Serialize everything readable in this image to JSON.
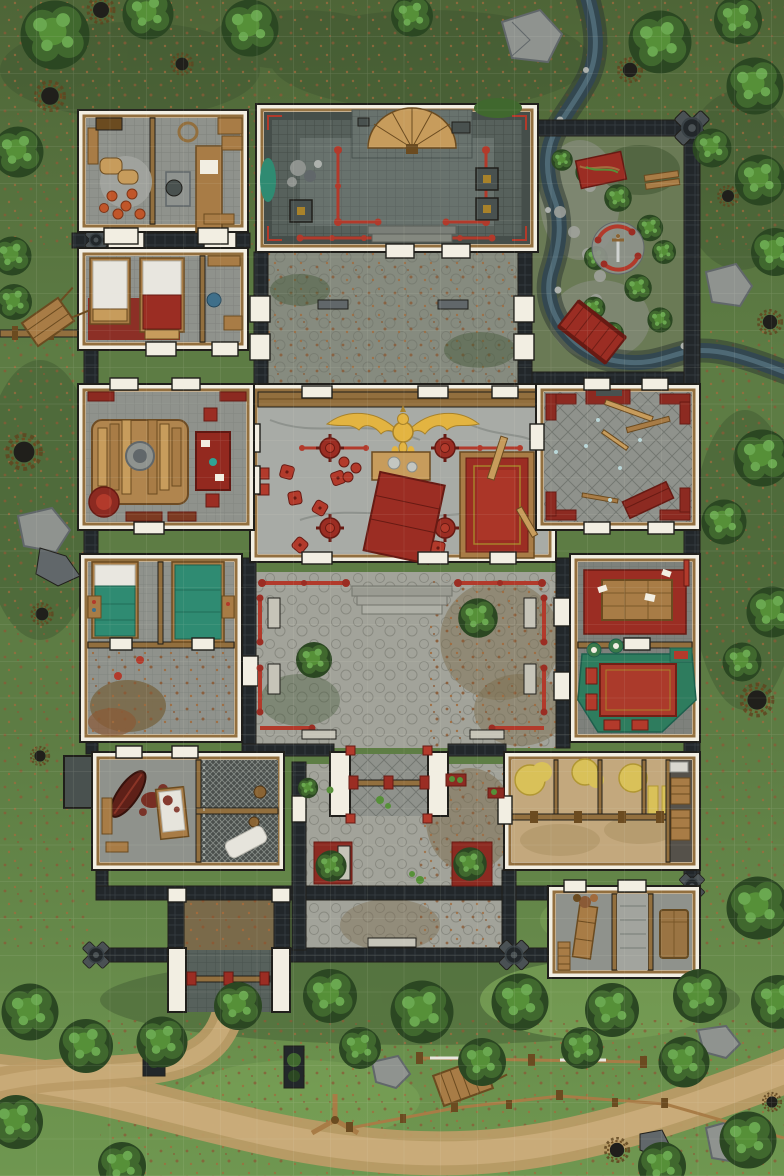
{
  "map": {
    "title": "Top-down fantasy battle map of a walled temple compound surrounded by forest",
    "style": "hand-drawn TTRPG battle map, overhead view",
    "grid": {
      "visible": true,
      "cell_px": 36.75,
      "columns": 21,
      "rows": 32
    },
    "areas": [
      "forest-surroundings",
      "stream",
      "walled-garden",
      "north-hall",
      "storeroom",
      "guest-bedrooms",
      "north-courtyard",
      "main-hall",
      "west-shrine-room",
      "east-hall",
      "central-courtyard",
      "west-bedrooms",
      "east-dining-room",
      "south-courtyard",
      "north-gatehouse",
      "south-gatehouse",
      "southwest-quarters",
      "jail-cells",
      "stable",
      "south-annex",
      "perimeter-wall",
      "dirt-road"
    ],
    "landmarks": [
      "golden-dragon-statue",
      "red-dais-carpet",
      "sword-shrine-circle",
      "red-bridge",
      "red-banner",
      "altar-fan",
      "hay-piles",
      "coffin",
      "teal-beds",
      "blood-stained-bed"
    ],
    "palette": {
      "grass1": "#4e6537",
      "grass2": "#5d7c44",
      "grass3": "#6f9750",
      "moss": "#3c5230",
      "mossHi": "#82ab5c",
      "litterA": "#8a5a36",
      "litterB": "#a16b3d",
      "treeDk": "#2b4722",
      "treeMd": "#40682e",
      "treeLt": "#569038",
      "treeHi": "#6aa850",
      "rock": "#8f938f",
      "rockDk": "#61676a",
      "rockLt": "#adb1ad",
      "stream": "#334750",
      "streamHi": "#5e7d88",
      "bank": "#2f3b33",
      "wall": "#22272a",
      "wallLn": "#3a4246",
      "wallWood": "#6b5232",
      "post": "#4a5154",
      "white": "#f2eee2",
      "edge": "#201f1b",
      "trim": "#926f3e",
      "trimDk": "#5f4520",
      "floor": "#8f928c",
      "floorLt": "#a2a49e",
      "floorDk": "#49514f",
      "hallFloor": "#57615c",
      "hallBand": "#454e4a",
      "hallPanel": "#68726d",
      "marble": "#a8aba6",
      "red": "#9b2d23",
      "redBt": "#b23a2b",
      "redDk": "#671a13",
      "redwood": "#8c2a21",
      "gold": "#e3b441",
      "goldDk": "#a8822a",
      "teal": "#2f8b72",
      "tealDk": "#1d5f4d",
      "tealRug": "#2e7c5e",
      "wood": "#a87c46",
      "woodDk": "#6b4b20",
      "woodLt": "#c79c5c",
      "stable": "#c3a87d",
      "stableDk": "#a98f62",
      "hay": "#d9c159",
      "hayDk": "#b19733",
      "cobble": "#a2a39a",
      "cobbleDk": "#7f8077",
      "stoneLt": "#c6c4b8",
      "pathA": "#ba9b66",
      "pathB": "#ccae7c",
      "glass": "#bad7d9",
      "blood": "#731c10",
      "cell": "#4b504d",
      "mesh": "#a7adaa",
      "corridor": "#7a6a4a"
    }
  }
}
